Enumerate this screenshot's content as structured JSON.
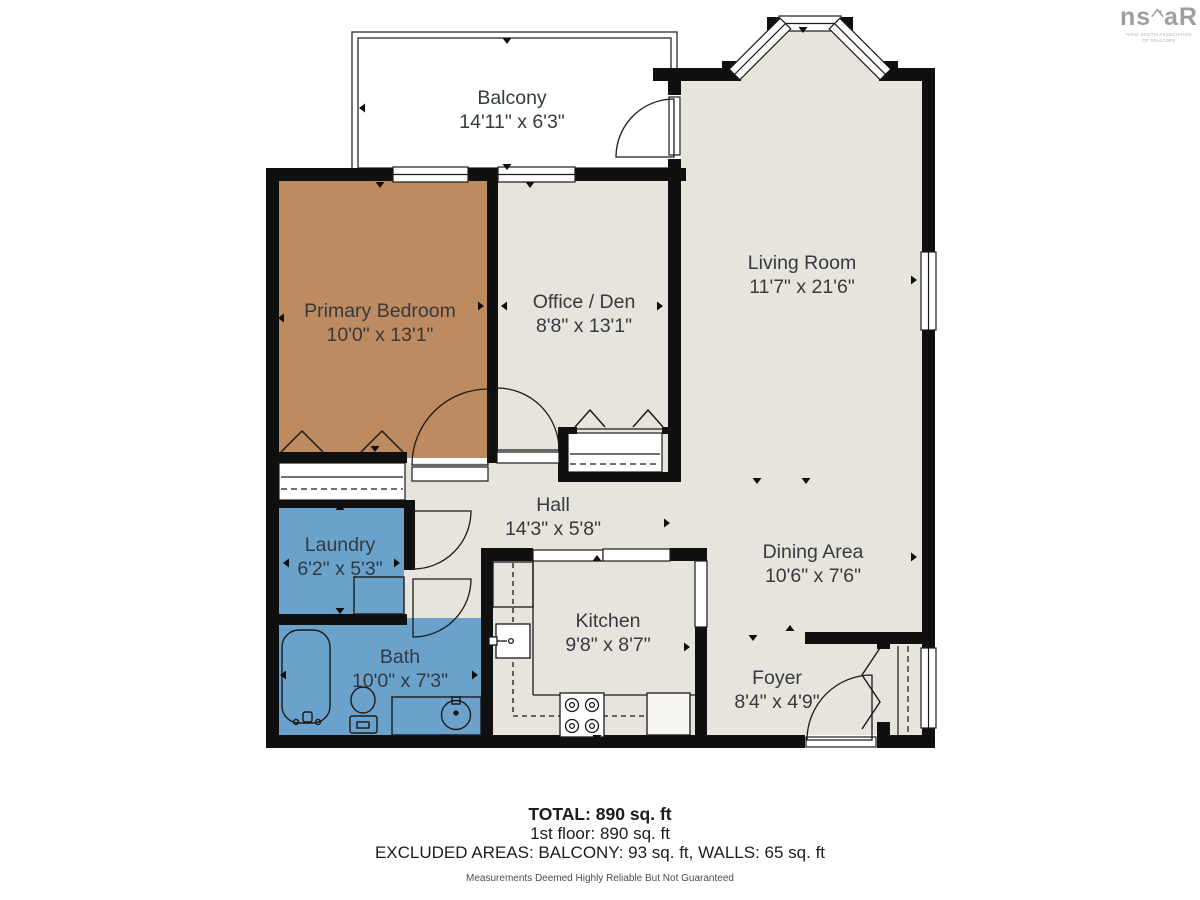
{
  "logo": {
    "brand_left": "ns",
    "brand_right": "aR",
    "tagline_line1": "NOVA SCOTIA ASSOCIATION",
    "tagline_line2": "OF REALTORS"
  },
  "rooms": [
    {
      "id": "balcony",
      "name": "Balcony",
      "dims": "14'11\" x 6'3\""
    },
    {
      "id": "primary-bedroom",
      "name": "Primary Bedroom",
      "dims": "10'0\" x 13'1\""
    },
    {
      "id": "office-den",
      "name": "Office / Den",
      "dims": "8'8\" x 13'1\""
    },
    {
      "id": "living-room",
      "name": "Living Room",
      "dims": "11'7\" x 21'6\""
    },
    {
      "id": "hall",
      "name": "Hall",
      "dims": "14'3\" x 5'8\""
    },
    {
      "id": "laundry",
      "name": "Laundry",
      "dims": "6'2\" x 5'3\""
    },
    {
      "id": "bath",
      "name": "Bath",
      "dims": "10'0\" x 7'3\""
    },
    {
      "id": "kitchen",
      "name": "Kitchen",
      "dims": "9'8\" x 8'7\""
    },
    {
      "id": "dining-area",
      "name": "Dining Area",
      "dims": "10'6\" x 7'6\""
    },
    {
      "id": "foyer",
      "name": "Foyer",
      "dims": "8'4\" x 4'9\""
    }
  ],
  "summary": {
    "total": "TOTAL: 890 sq. ft",
    "floor": "1st floor: 890 sq. ft",
    "excluded": "EXCLUDED AREAS: BALCONY: 93 sq. ft, WALLS: 65 sq. ft",
    "disclaimer": "Measurements Deemed Highly Reliable But Not Guaranteed"
  },
  "colors": {
    "bedroom_fill": "#BE8A5F",
    "wet_fill": "#6AA2CC",
    "floor_fill": "#E6E4DC",
    "wall": "#101010"
  }
}
